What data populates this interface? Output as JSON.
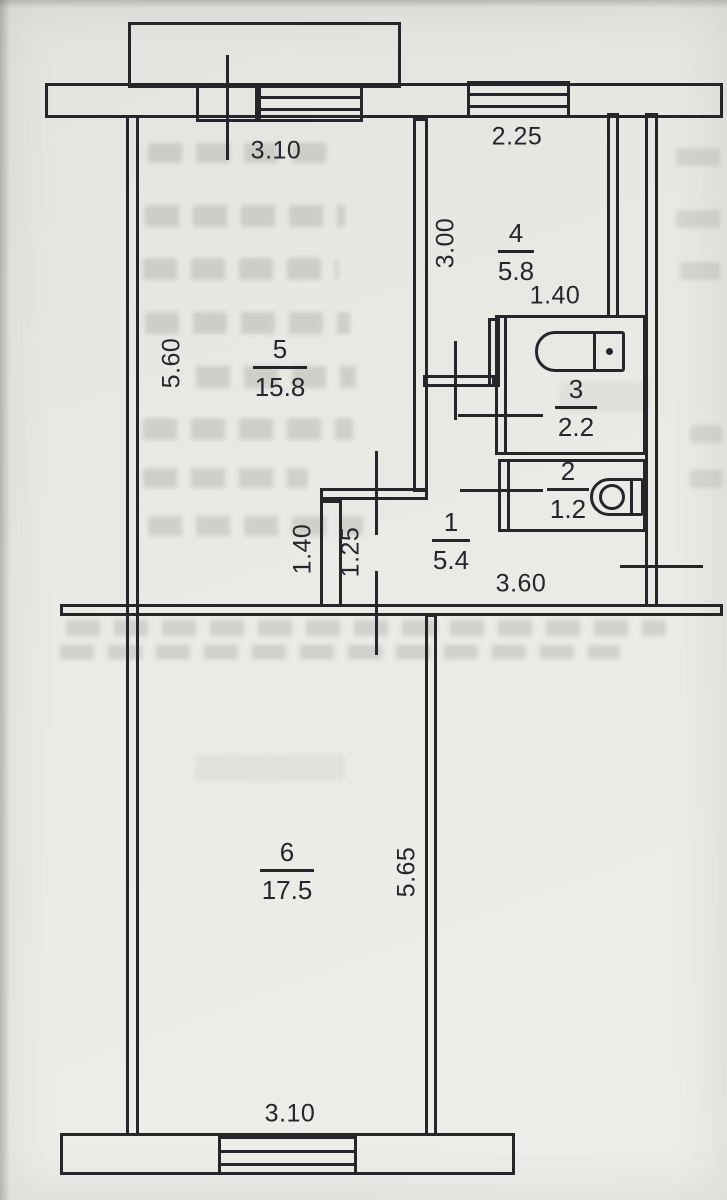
{
  "plan": {
    "type": "apartment-floor-plan",
    "rooms": [
      {
        "number": "1",
        "area": "5.4"
      },
      {
        "number": "2",
        "area": "1.2"
      },
      {
        "number": "3",
        "area": "2.2"
      },
      {
        "number": "4",
        "area": "5.8"
      },
      {
        "number": "5",
        "area": "15.8"
      },
      {
        "number": "6",
        "area": "17.5"
      }
    ],
    "dimensions": [
      {
        "value": "3.10",
        "orientation": "horizontal",
        "location": "room-5-top"
      },
      {
        "value": "2.25",
        "orientation": "horizontal",
        "location": "room-4-top"
      },
      {
        "value": "3.00",
        "orientation": "vertical",
        "location": "room-4-left"
      },
      {
        "value": "1.40",
        "orientation": "horizontal",
        "location": "room-3-top"
      },
      {
        "value": "5.60",
        "orientation": "vertical",
        "location": "room-5-left"
      },
      {
        "value": "1.40",
        "orientation": "vertical",
        "location": "hall-left"
      },
      {
        "value": "1.25",
        "orientation": "vertical",
        "location": "hall-notch"
      },
      {
        "value": "3.60",
        "orientation": "horizontal",
        "location": "hall-bottom"
      },
      {
        "value": "5.65",
        "orientation": "vertical",
        "location": "room-6-right"
      },
      {
        "value": "3.10",
        "orientation": "horizontal",
        "location": "room-6-bottom"
      }
    ],
    "fixtures": {
      "balcony": "balcony-outline",
      "bathtub": "bathtub-icon",
      "toilet": "toilet-icon",
      "windows": [
        "window-top-room5",
        "window-top-room4",
        "window-bottom-room6"
      ]
    },
    "colors": {
      "ink": "#26262a",
      "paper": "#eae9e5"
    }
  }
}
